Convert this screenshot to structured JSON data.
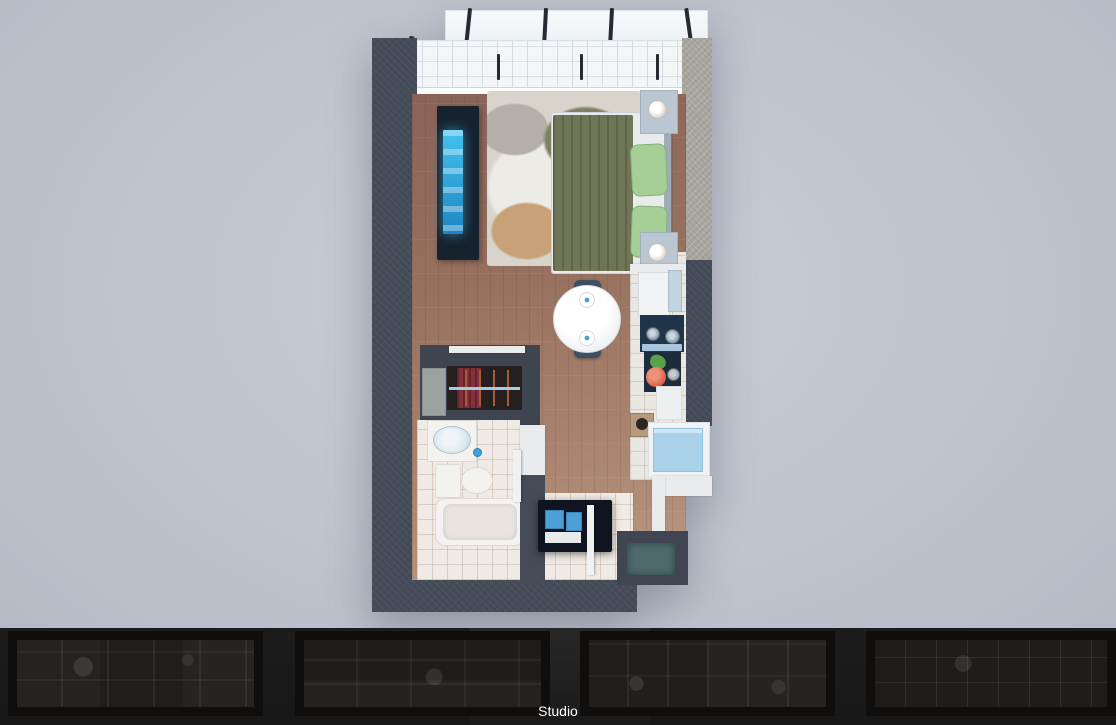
{
  "caption": {
    "title": "Tipología 2",
    "subtitle": "Studio"
  },
  "carousel": {
    "thumbnails": [
      {
        "name": "floorplan-thumbnail-1"
      },
      {
        "name": "floorplan-thumbnail-2"
      },
      {
        "name": "floorplan-thumbnail-3"
      },
      {
        "name": "floorplan-thumbnail-4"
      }
    ]
  },
  "colors": {
    "stage_center": "#c9cdd6",
    "stage_edge": "#b2b6c2",
    "strip_bg": "#181818",
    "caption_text": "#ffffff",
    "wall_dark": "#454c59",
    "wall_light": "#a9a69e",
    "floor_wood": "#8a6358",
    "tile": "#f0eae4",
    "accent_tv": "#45c2ee",
    "bed_duvet": "#6f7557",
    "pillow": "#a6cf97",
    "counter_dark": "#20344a",
    "washer": "#a9d2ea",
    "drawer_blue": "#4d9fd8",
    "tomato": "#d85840",
    "lettuce": "#58a24a",
    "clothes": "#84303a",
    "rug_olive": "#7c8162",
    "rug_tan": "#c8a276",
    "mat_teal": "#4e6a6b"
  }
}
